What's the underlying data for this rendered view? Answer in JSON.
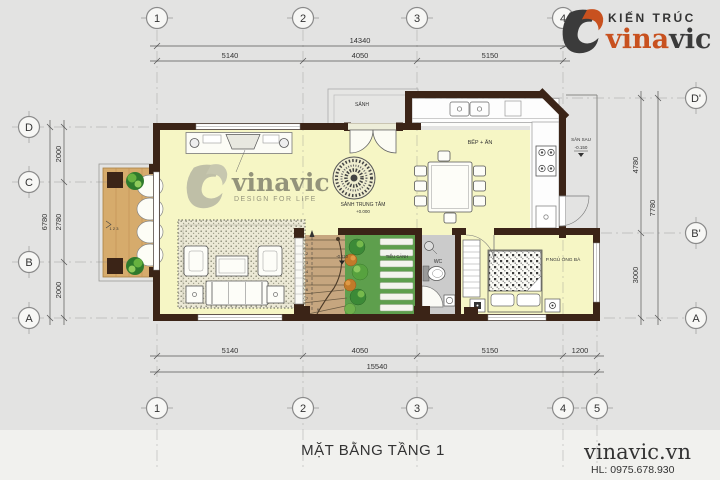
{
  "brand": {
    "kien_truc": "KIẾN TRÚC",
    "vina": "vina",
    "vic": "vic"
  },
  "watermark": {
    "name": "vinavic",
    "tagline": "DESIGN FOR LIFE"
  },
  "title_block": {
    "drawing_title": "MẶT BẰNG TẦNG 1",
    "website": "vinavic.vn",
    "hotline": "HL: 0975.678.930"
  },
  "axes": {
    "top": [
      "1",
      "2",
      "3",
      "4"
    ],
    "bottom": [
      "1",
      "2",
      "3",
      "4",
      "5"
    ],
    "left": [
      "D",
      "C",
      "B",
      "A"
    ],
    "right": [
      "D'",
      "B'",
      "A"
    ]
  },
  "dims": {
    "top_total": "14340",
    "top_segments": [
      "5140",
      "4050",
      "5150"
    ],
    "bottom_segments": [
      "5140",
      "4050",
      "5150",
      "1200"
    ],
    "bottom_total": "15540",
    "left_segments": [
      "2000",
      "2780",
      "2000"
    ],
    "left_total": "6780",
    "right_segments": [
      "4780",
      "3000"
    ],
    "right_total": "7780"
  },
  "rooms": {
    "entry": "SẢNH",
    "hall": "SẢNH TRUNG TÂM",
    "hall_level": "+0.000",
    "kitchen": "BẾP + ĂN",
    "backyard": "SÂN SAU",
    "backyard_level": "-0.150",
    "garden": "TIỂU CẢNH",
    "garden_level": "-0.110",
    "wc": "WC",
    "bedroom": "P.NGỦ ÔNG BÀ"
  },
  "stairs": {
    "step_numbers": [
      "1",
      "2",
      "3",
      "4",
      "5",
      "6",
      "7",
      "8",
      "9"
    ]
  },
  "porch": {
    "steps_label": "1 2 3"
  },
  "colors": {
    "brand_orange": "#C8511F",
    "wall": "#3B2417",
    "floor_yellow": "#F6F6C5",
    "garden_green": "#5E9F4D",
    "porch_tan": "#D6AB6C"
  }
}
